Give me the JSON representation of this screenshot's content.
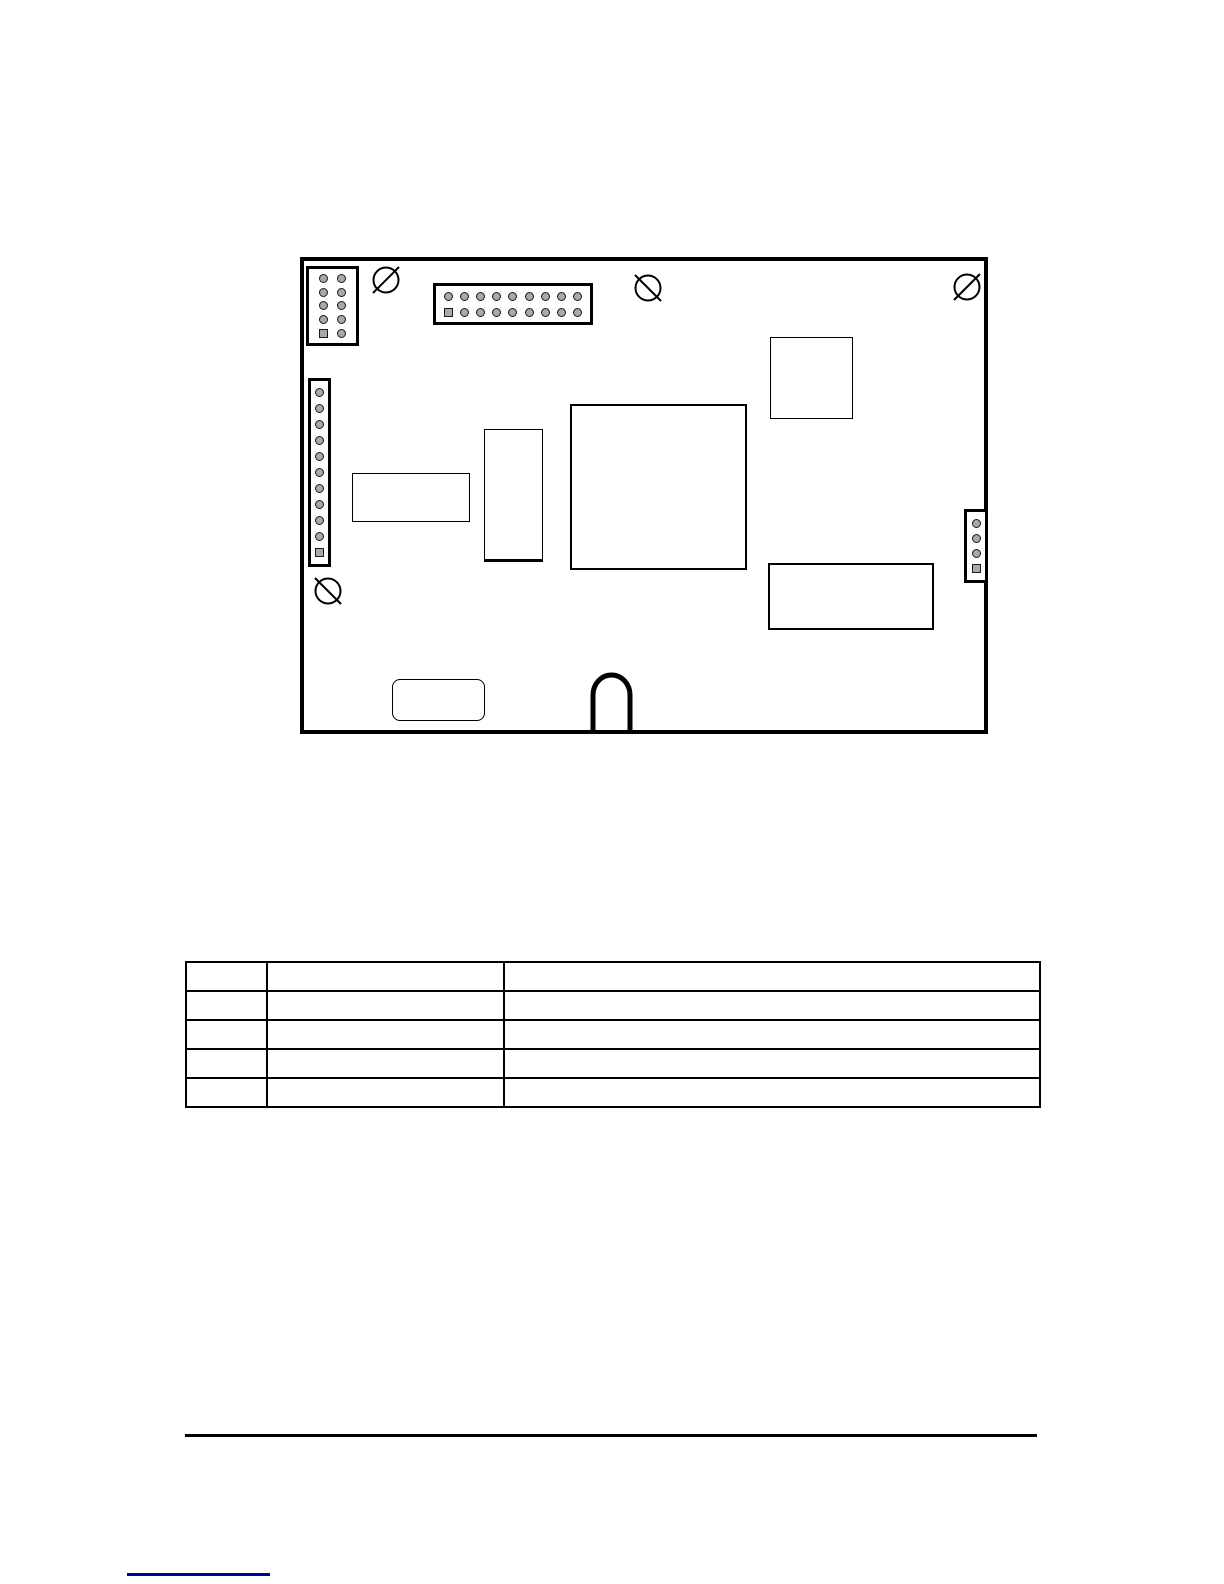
{
  "page": {
    "background": "#ffffff",
    "ink_color": "#000000"
  },
  "board": {
    "label": "pcb-board-outline",
    "outline_color": "#000000",
    "pin_fill_color": "#a8a8a8",
    "connectors": [
      {
        "id": "pin-header-2x5",
        "rows": 5,
        "cols": 2,
        "pin_count": 10,
        "pin1_marker": "square-bottom-left"
      },
      {
        "id": "pin-header-2x9",
        "rows": 2,
        "cols": 9,
        "pin_count": 18,
        "pin1_marker": "square-bottom-left"
      },
      {
        "id": "pin-header-1x11",
        "rows": 11,
        "cols": 1,
        "pin_count": 11,
        "pin1_marker": "square-bottom"
      },
      {
        "id": "pin-header-1x4",
        "rows": 4,
        "cols": 1,
        "pin_count": 4,
        "pin1_marker": "square-bottom"
      }
    ],
    "mounting_holes": [
      {
        "id": "mounting-hole-top-left",
        "slash": "/"
      },
      {
        "id": "mounting-hole-top-center",
        "slash": "\\"
      },
      {
        "id": "mounting-hole-top-right",
        "slash": "/"
      },
      {
        "id": "mounting-hole-bottom-left",
        "slash": "\\"
      }
    ],
    "components": [
      "small-ic-top-right",
      "large-ic-center",
      "vertical-module",
      "horizontal-module",
      "lower-right-module",
      "rounded-module-bottom",
      "cable-notch-bottom"
    ]
  },
  "table": {
    "columns": [
      "",
      "",
      ""
    ],
    "rows": [
      [
        "",
        "",
        ""
      ],
      [
        "",
        "",
        ""
      ],
      [
        "",
        "",
        ""
      ],
      [
        "",
        "",
        ""
      ]
    ]
  },
  "footer": {
    "rule": "horizontal-rule",
    "link_underline_color": "#000099"
  }
}
